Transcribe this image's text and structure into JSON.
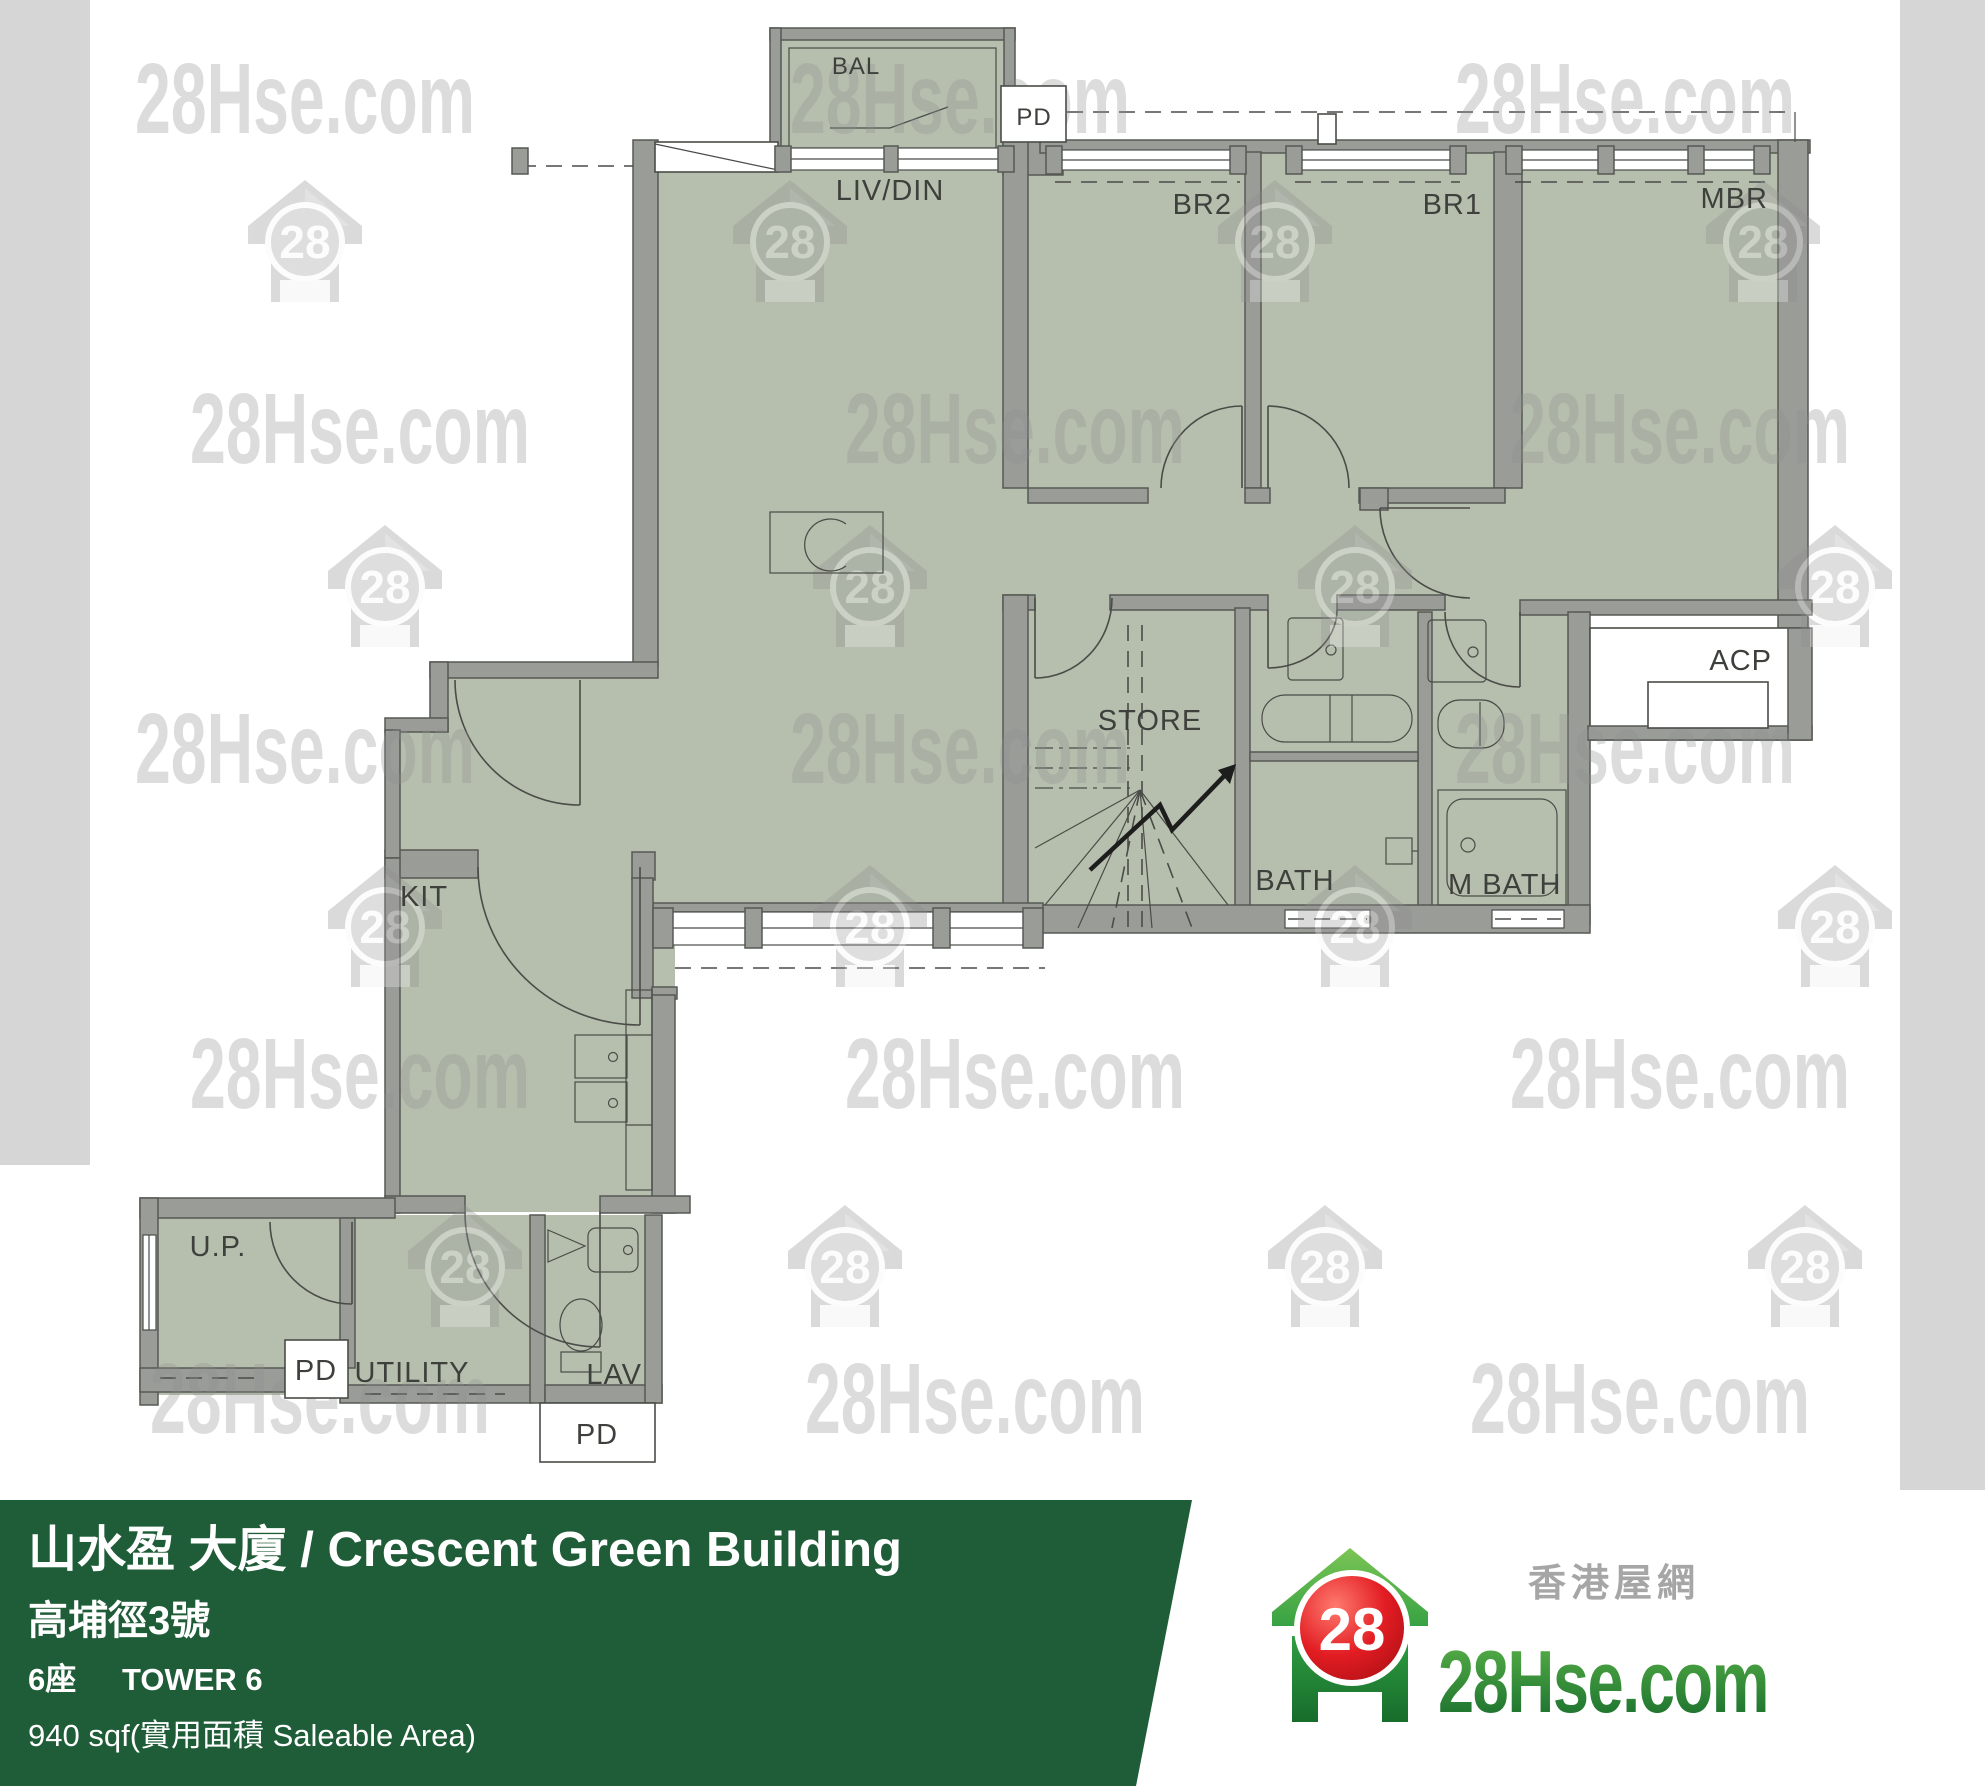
{
  "watermark": {
    "text": "28Hse.com",
    "badge": "28"
  },
  "plan": {
    "labels": {
      "bal": "BAL",
      "pd_top": "PD",
      "liv": "LIV/DIN",
      "br2": "BR2",
      "br1": "BR1",
      "mbr": "MBR",
      "store": "STORE",
      "bath": "BATH",
      "mbath": "M  BATH",
      "acp": "ACP",
      "kit": "KIT",
      "up": "U.P.",
      "pd_mid": "PD",
      "utility": "UTILITY",
      "lav": "LAV",
      "pd_bottom": "PD"
    }
  },
  "banner": {
    "building_name": "山水盈 大廈 / Crescent Green Building",
    "address": "高埔徑3號",
    "tower_zh": "6座",
    "tower_en": "TOWER 6",
    "area": "940 sqf(實用面積 Saleable Area)",
    "background": "#1f5c38"
  },
  "logo": {
    "brand": "28Hse.com",
    "tagline": "香港屋網",
    "badge": "28",
    "green": "#2e9e41",
    "red": "#e21d23"
  },
  "colors": {
    "floor": "#b6bfae",
    "wall": "#9a9c98",
    "side_band": "#d6d6d6",
    "watermark": "#8f8f8f",
    "label": "#3e403c"
  }
}
